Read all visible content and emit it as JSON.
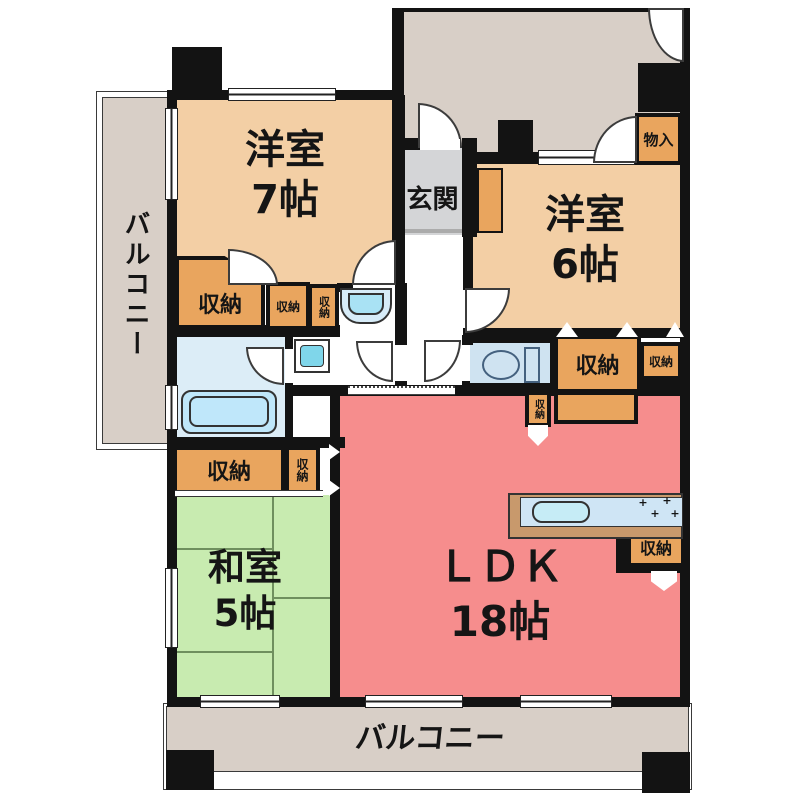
{
  "floorplan": {
    "rooms": {
      "western_room_7": {
        "name": "洋室",
        "size": "7帖"
      },
      "western_room_6": {
        "name": "洋室",
        "size": "6帖"
      },
      "japanese_room_5": {
        "name": "和室",
        "size": "5帖"
      },
      "ldk": {
        "name": "ＬＤＫ",
        "size": "18帖"
      },
      "entrance": {
        "name": "玄関"
      },
      "balcony_left": {
        "name": "バルコニー"
      },
      "balcony_bottom": {
        "name": "バルコニー"
      }
    },
    "labels": {
      "storage": "収納",
      "closet": "物入"
    },
    "colors": {
      "wall": "#131313",
      "western_room": "#f3cfa5",
      "japanese_room": "#c8ebb0",
      "ldk": "#f68d8d",
      "storage": "#e9a55e",
      "entrance_gray": "#d4d5d7",
      "balcony_corridor": "#d8cfc7",
      "bathroom": "#dcedf7",
      "toilet_room": "#cfe3f1",
      "fixture_blue": "#bfe7fa",
      "counter_wood": "#c8996c"
    }
  }
}
